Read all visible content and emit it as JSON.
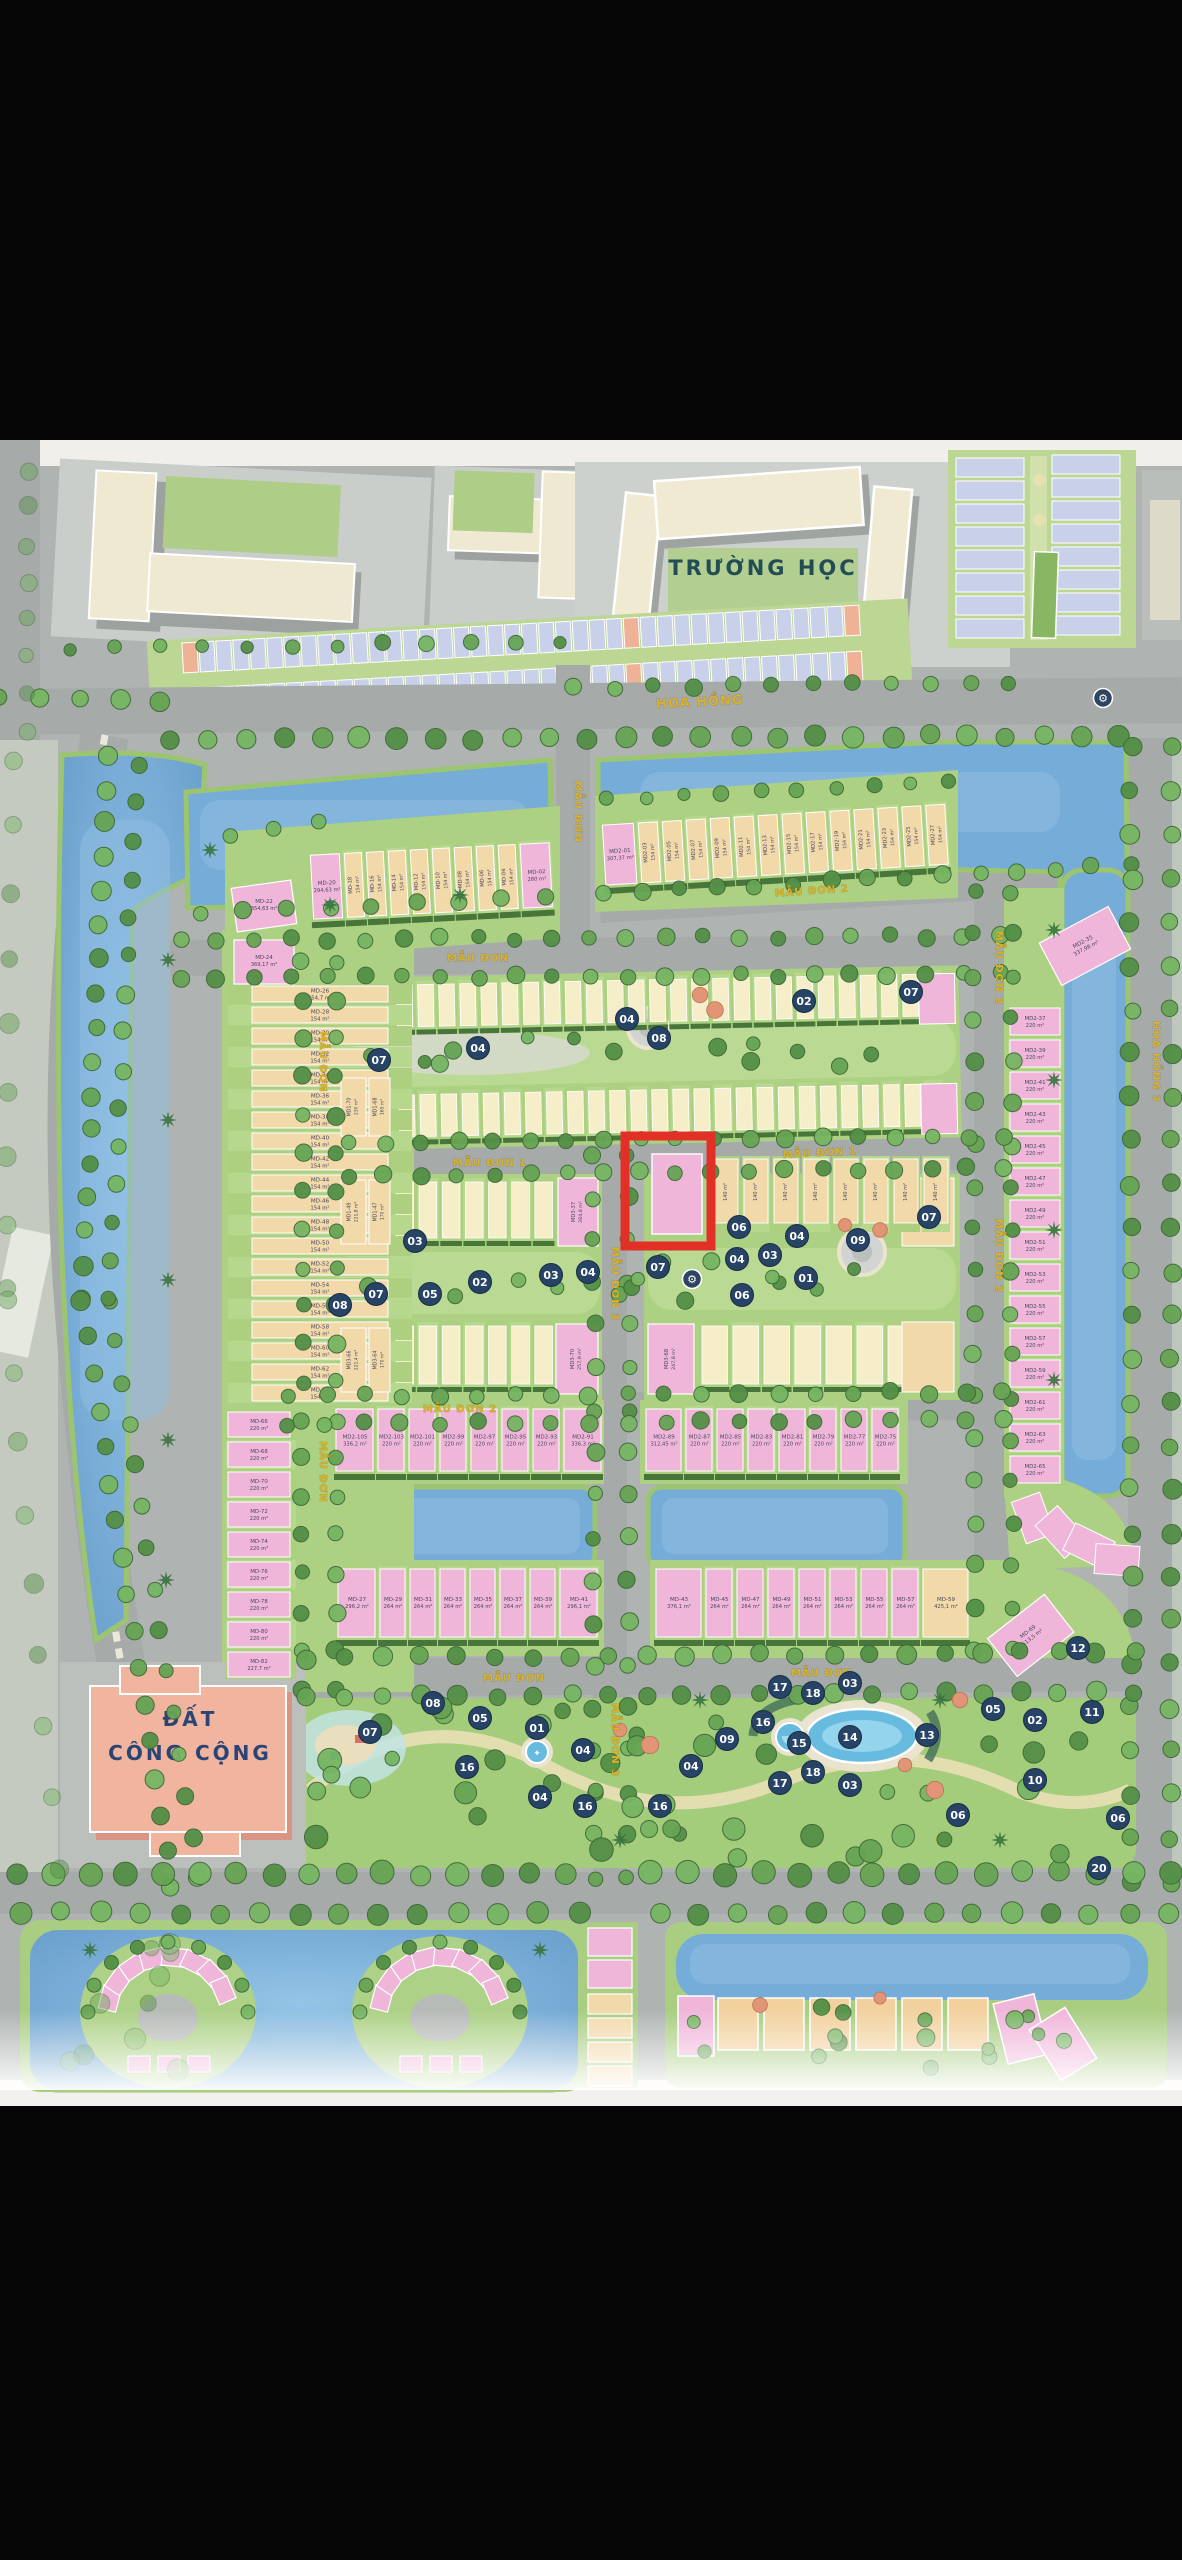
{
  "labels": {
    "school": "TRƯỜNG HỌC",
    "public_land_1": "ĐẤT",
    "public_land_2": "CÔNG CỘNG"
  },
  "colors": {
    "water": "#6fa8d6",
    "road": "#a6abaa",
    "green": "#a9cf7d",
    "tree_green": "#4a8a3d",
    "cream_house": "#f2d7a6",
    "pink_house": "#f0b3d8",
    "pale_row_house": "#f6eec6",
    "blue_roof": "#c7cfe9",
    "highlight_red": "#e1251b",
    "marker_navy": "#1c3a5e",
    "street_yellow": "#d9af1e",
    "school_text": "#17444b",
    "public_text": "#1e3a6e"
  },
  "streets": [
    {
      "label": "HOA HỒNG",
      "x": 700,
      "y": 706,
      "rot": -3,
      "s": 13
    },
    {
      "label": "MẪU ĐƠN",
      "x": 575,
      "y": 812,
      "rot": 90,
      "s": 10
    },
    {
      "label": "MẪU ĐƠN",
      "x": 478,
      "y": 961,
      "rot": 0,
      "s": 10
    },
    {
      "label": "MẪU ĐƠN 2",
      "x": 812,
      "y": 894,
      "rot": -4,
      "s": 10
    },
    {
      "label": "MẪU ĐƠN",
      "x": 320,
      "y": 1062,
      "rot": 90,
      "s": 10
    },
    {
      "label": "MẪU ĐƠN",
      "x": 320,
      "y": 1472,
      "rot": 90,
      "s": 10
    },
    {
      "label": "MẪU ĐƠN 1",
      "x": 490,
      "y": 1166,
      "rot": 0,
      "s": 10
    },
    {
      "label": "MẪU ĐƠN 1",
      "x": 820,
      "y": 1156,
      "rot": -3,
      "s": 10
    },
    {
      "label": "MẪU ĐƠN 2",
      "x": 996,
      "y": 968,
      "rot": 90,
      "s": 10
    },
    {
      "label": "MẪU ĐƠN 2",
      "x": 996,
      "y": 1256,
      "rot": 90,
      "s": 10
    },
    {
      "label": "MẪU ĐƠN 2",
      "x": 460,
      "y": 1412,
      "rot": 0,
      "s": 10
    },
    {
      "label": "MẪU ĐƠN 3",
      "x": 612,
      "y": 1284,
      "rot": 90,
      "s": 10
    },
    {
      "label": "MẪU ĐƠN 3",
      "x": 612,
      "y": 1740,
      "rot": 90,
      "s": 10
    },
    {
      "label": "MẪU ĐƠN",
      "x": 514,
      "y": 1681,
      "rot": 0,
      "s": 10
    },
    {
      "label": "MẪU ĐƠN",
      "x": 822,
      "y": 1676,
      "rot": 0,
      "s": 10
    },
    {
      "label": "HOA HỒNG 3",
      "x": 1153,
      "y": 1062,
      "rot": 90,
      "s": 10
    }
  ],
  "highlight_lot": {
    "name": "MD2-29",
    "area": "208,1 m²"
  },
  "lots": {
    "top_row": [
      {
        "n": "MD-20",
        "a": "294,63 m²",
        "c": "p"
      },
      {
        "n": "MD-18",
        "a": "154 m²",
        "c": "c"
      },
      {
        "n": "MD-16",
        "a": "154 m²",
        "c": "c"
      },
      {
        "n": "MD-14",
        "a": "154 m²",
        "c": "c"
      },
      {
        "n": "MD-12",
        "a": "154 m²",
        "c": "c"
      },
      {
        "n": "MD-10",
        "a": "154 m²",
        "c": "c"
      },
      {
        "n": "MD-08",
        "a": "154 m²",
        "c": "c"
      },
      {
        "n": "MD-06",
        "a": "154 m²",
        "c": "c"
      },
      {
        "n": "MD-04",
        "a": "154 m²",
        "c": "c"
      },
      {
        "n": "MD-02",
        "a": "280 m²",
        "c": "p"
      }
    ],
    "corner_west": [
      {
        "n": "MD-22",
        "a": "354,63 m²",
        "c": "p"
      },
      {
        "n": "MD-24",
        "a": "369,17 m²",
        "c": "p"
      }
    ],
    "west_column_cream": [
      {
        "n": "MD-26",
        "a": "154,7 m²",
        "c": "c"
      },
      {
        "n": "MD-28",
        "a": "154 m²",
        "c": "c"
      },
      {
        "n": "MD-30",
        "a": "154 m²",
        "c": "c"
      },
      {
        "n": "MD-32",
        "a": "154 m²",
        "c": "c"
      },
      {
        "n": "MD-34",
        "a": "154 m²",
        "c": "c"
      },
      {
        "n": "MD-36",
        "a": "154 m²",
        "c": "c"
      },
      {
        "n": "MD-38",
        "a": "154 m²",
        "c": "c"
      },
      {
        "n": "MD-40",
        "a": "154 m²",
        "c": "c"
      },
      {
        "n": "MD-42",
        "a": "154 m²",
        "c": "c"
      },
      {
        "n": "MD-44",
        "a": "154 m²",
        "c": "c"
      },
      {
        "n": "MD-46",
        "a": "154 m²",
        "c": "c"
      },
      {
        "n": "MD-48",
        "a": "154 m²",
        "c": "c"
      },
      {
        "n": "MD-50",
        "a": "154 m²",
        "c": "c"
      },
      {
        "n": "MD-52",
        "a": "154 m²",
        "c": "c"
      },
      {
        "n": "MD-54",
        "a": "154 m²",
        "c": "c"
      },
      {
        "n": "MD-56",
        "a": "154 m²",
        "c": "c"
      },
      {
        "n": "MD-58",
        "a": "154 m²",
        "c": "c"
      },
      {
        "n": "MD-60",
        "a": "154 m²",
        "c": "c"
      },
      {
        "n": "MD-62",
        "a": "154 m²",
        "c": "c"
      },
      {
        "n": "MD-64",
        "a": "154 m²",
        "c": "c"
      }
    ],
    "west_column_pink": [
      {
        "n": "MD-66",
        "a": "220 m²",
        "c": "p"
      },
      {
        "n": "MD-68",
        "a": "220 m²",
        "c": "p"
      },
      {
        "n": "MD-70",
        "a": "220 m²",
        "c": "p"
      },
      {
        "n": "MD-72",
        "a": "220 m²",
        "c": "p"
      },
      {
        "n": "MD-74",
        "a": "220 m²",
        "c": "p"
      },
      {
        "n": "MD-76",
        "a": "220 m²",
        "c": "p"
      },
      {
        "n": "MD-78",
        "a": "220 m²",
        "c": "p"
      },
      {
        "n": "MD-80",
        "a": "220 m²",
        "c": "p"
      },
      {
        "n": "MD-82",
        "a": "227,7 m²",
        "c": "p"
      }
    ],
    "md2_row": [
      {
        "n": "MD2-01",
        "a": "307,37 m²",
        "c": "p"
      },
      {
        "n": "MD2-03",
        "a": "154 m²",
        "c": "c"
      },
      {
        "n": "MD2-05",
        "a": "154 m²",
        "c": "c"
      },
      {
        "n": "MD2-07",
        "a": "154 m²",
        "c": "c"
      },
      {
        "n": "MD2-09",
        "a": "154 m²",
        "c": "c"
      },
      {
        "n": "MD2-11",
        "a": "154 m²",
        "c": "c"
      },
      {
        "n": "MD2-13",
        "a": "154 m²",
        "c": "c"
      },
      {
        "n": "MD2-15",
        "a": "154 m²",
        "c": "c"
      },
      {
        "n": "MD2-17",
        "a": "154 m²",
        "c": "c"
      },
      {
        "n": "MD2-19",
        "a": "154 m²",
        "c": "c"
      },
      {
        "n": "MD2-21",
        "a": "154 m²",
        "c": "c"
      },
      {
        "n": "MD2-23",
        "a": "154 m²",
        "c": "c"
      },
      {
        "n": "MD2-25",
        "a": "154 m²",
        "c": "c"
      },
      {
        "n": "MD2-27",
        "a": "154 m²",
        "c": "c"
      }
    ],
    "east_corner": {
      "n": "MD2-35",
      "a": "337,98 m²",
      "c": "p"
    },
    "east_column": [
      {
        "n": "MD2-37",
        "a": "220 m²",
        "c": "p"
      },
      {
        "n": "MD2-39",
        "a": "220 m²",
        "c": "p"
      },
      {
        "n": "MD2-41",
        "a": "220 m²",
        "c": "p"
      },
      {
        "n": "MD2-43",
        "a": "220 m²",
        "c": "p"
      },
      {
        "n": "MD2-45",
        "a": "220 m²",
        "c": "p"
      },
      {
        "n": "MD2-47",
        "a": "220 m²",
        "c": "p"
      },
      {
        "n": "MD2-49",
        "a": "220 m²",
        "c": "p"
      },
      {
        "n": "MD2-51",
        "a": "220 m²",
        "c": "p"
      },
      {
        "n": "MD2-53",
        "a": "220 m²",
        "c": "p"
      },
      {
        "n": "MD2-55",
        "a": "220 m²",
        "c": "p"
      },
      {
        "n": "MD2-57",
        "a": "220 m²",
        "c": "p"
      },
      {
        "n": "MD2-59",
        "a": "220 m²",
        "c": "p"
      },
      {
        "n": "MD2-61",
        "a": "220 m²",
        "c": "p"
      },
      {
        "n": "MD2-63",
        "a": "220 m²",
        "c": "p"
      },
      {
        "n": "MD2-65",
        "a": "220 m²",
        "c": "p"
      }
    ],
    "lower_left": [
      {
        "n": "MD2-105",
        "a": "336,2 m²",
        "c": "p"
      },
      {
        "n": "MD2-103",
        "a": "220 m²",
        "c": "p"
      },
      {
        "n": "MD2-101",
        "a": "220 m²",
        "c": "p"
      },
      {
        "n": "MD2-99",
        "a": "220 m²",
        "c": "p"
      },
      {
        "n": "MD2-97",
        "a": "220 m²",
        "c": "p"
      },
      {
        "n": "MD2-95",
        "a": "220 m²",
        "c": "p"
      },
      {
        "n": "MD2-93",
        "a": "220 m²",
        "c": "p"
      },
      {
        "n": "MD2-91",
        "a": "336,3 m²",
        "c": "p"
      }
    ],
    "lower_right": [
      {
        "n": "MD2-89",
        "a": "312,45 m²",
        "c": "p"
      },
      {
        "n": "MD2-87",
        "a": "220 m²",
        "c": "p"
      },
      {
        "n": "MD2-85",
        "a": "220 m²",
        "c": "p"
      },
      {
        "n": "MD2-83",
        "a": "220 m²",
        "c": "p"
      },
      {
        "n": "MD2-81",
        "a": "220 m²",
        "c": "p"
      },
      {
        "n": "MD2-79",
        "a": "220 m²",
        "c": "p"
      },
      {
        "n": "MD2-77",
        "a": "220 m²",
        "c": "p"
      },
      {
        "n": "MD2-75",
        "a": "220 m²",
        "c": "p"
      }
    ],
    "bottom_left": [
      {
        "n": "MD-27",
        "a": "296,2 m²",
        "c": "p"
      },
      {
        "n": "MD-29",
        "a": "264 m²",
        "c": "p"
      },
      {
        "n": "MD-31",
        "a": "264 m²",
        "c": "p"
      },
      {
        "n": "MD-33",
        "a": "264 m²",
        "c": "p"
      },
      {
        "n": "MD-35",
        "a": "264 m²",
        "c": "p"
      },
      {
        "n": "MD-37",
        "a": "264 m²",
        "c": "p"
      },
      {
        "n": "MD-39",
        "a": "264 m²",
        "c": "p"
      },
      {
        "n": "MD-41",
        "a": "296,1 m²",
        "c": "p"
      }
    ],
    "bottom_right": [
      {
        "n": "MD-43",
        "a": "376,1 m²",
        "c": "p"
      },
      {
        "n": "MD-45",
        "a": "264 m²",
        "c": "p"
      },
      {
        "n": "MD-47",
        "a": "264 m²",
        "c": "p"
      },
      {
        "n": "MD-49",
        "a": "264 m²",
        "c": "p"
      },
      {
        "n": "MD-51",
        "a": "264 m²",
        "c": "p"
      },
      {
        "n": "MD-53",
        "a": "264 m²",
        "c": "p"
      },
      {
        "n": "MD-55",
        "a": "264 m²",
        "c": "p"
      },
      {
        "n": "MD-57",
        "a": "264 m²",
        "c": "p"
      },
      {
        "n": "MD-59",
        "a": "425,1 m²",
        "c": "c"
      }
    ],
    "bottom_corner": {
      "n": "MD-69",
      "a": "513,5 m²",
      "c": "p"
    },
    "block_corner_lots": [
      {
        "n": "MD1-70",
        "a": "230 m²",
        "c": "c",
        "x": 341,
        "y": 1078,
        "w": 25,
        "h": 58
      },
      {
        "n": "MD1-68",
        "a": "165 m²",
        "c": "c",
        "x": 369,
        "y": 1078,
        "w": 21,
        "h": 58
      },
      {
        "n": "MD1-49",
        "a": "221,8 m²",
        "c": "c",
        "x": 341,
        "y": 1180,
        "w": 25,
        "h": 64
      },
      {
        "n": "MD1-47",
        "a": "170 m²",
        "c": "c",
        "x": 369,
        "y": 1180,
        "w": 21,
        "h": 64
      },
      {
        "n": "MD3-66",
        "a": "221,4 m²",
        "c": "c",
        "x": 341,
        "y": 1328,
        "w": 25,
        "h": 64
      },
      {
        "n": "MD3-64",
        "a": "170 m²",
        "c": "c",
        "x": 369,
        "y": 1328,
        "w": 21,
        "h": 64
      }
    ],
    "block_end_lots": [
      {
        "n": "MD3-37",
        "a": "284,8 m²",
        "c": "p",
        "x": 558,
        "y": 1178,
        "w": 40,
        "h": 68
      },
      {
        "n": "MD3-70",
        "a": "257,9 m²",
        "c": "p",
        "x": 556,
        "y": 1324,
        "w": 42,
        "h": 70
      },
      {
        "n": "MD3-68",
        "a": "247,8 m²",
        "c": "p",
        "x": 648,
        "y": 1324,
        "w": 46,
        "h": 70
      }
    ],
    "small_row": {
      "count": 8,
      "area": "140 m²"
    }
  },
  "markers": [
    {
      "n": "04",
      "x": 478,
      "y": 1048
    },
    {
      "n": "07",
      "x": 379,
      "y": 1060
    },
    {
      "n": "04",
      "x": 627,
      "y": 1019
    },
    {
      "n": "08",
      "x": 659,
      "y": 1038
    },
    {
      "n": "02",
      "x": 804,
      "y": 1001
    },
    {
      "n": "07",
      "x": 911,
      "y": 992
    },
    {
      "n": "03",
      "x": 415,
      "y": 1241
    },
    {
      "n": "05",
      "x": 430,
      "y": 1294
    },
    {
      "n": "07",
      "x": 376,
      "y": 1294
    },
    {
      "n": "08",
      "x": 340,
      "y": 1305
    },
    {
      "n": "02",
      "x": 480,
      "y": 1282
    },
    {
      "n": "03",
      "x": 551,
      "y": 1275
    },
    {
      "n": "04",
      "x": 588,
      "y": 1272
    },
    {
      "n": "07",
      "x": 658,
      "y": 1267
    },
    {
      "n": "06",
      "x": 739,
      "y": 1227
    },
    {
      "n": "04",
      "x": 797,
      "y": 1236
    },
    {
      "n": "03",
      "x": 770,
      "y": 1255
    },
    {
      "n": "04",
      "x": 737,
      "y": 1259
    },
    {
      "n": "01",
      "x": 806,
      "y": 1278
    },
    {
      "n": "06",
      "x": 742,
      "y": 1295
    },
    {
      "n": "09",
      "x": 858,
      "y": 1240
    },
    {
      "n": "07",
      "x": 929,
      "y": 1217
    },
    {
      "n": "12",
      "x": 1078,
      "y": 1648
    },
    {
      "n": "07",
      "x": 370,
      "y": 1732
    },
    {
      "n": "08",
      "x": 433,
      "y": 1703
    },
    {
      "n": "05",
      "x": 480,
      "y": 1718
    },
    {
      "n": "01",
      "x": 537,
      "y": 1728
    },
    {
      "n": "04",
      "x": 583,
      "y": 1750
    },
    {
      "n": "16",
      "x": 467,
      "y": 1767
    },
    {
      "n": "04",
      "x": 540,
      "y": 1797
    },
    {
      "n": "16",
      "x": 585,
      "y": 1806
    },
    {
      "n": "17",
      "x": 780,
      "y": 1687
    },
    {
      "n": "18",
      "x": 813,
      "y": 1693
    },
    {
      "n": "03",
      "x": 850,
      "y": 1683
    },
    {
      "n": "16",
      "x": 763,
      "y": 1722
    },
    {
      "n": "09",
      "x": 727,
      "y": 1739
    },
    {
      "n": "15",
      "x": 799,
      "y": 1743
    },
    {
      "n": "14",
      "x": 850,
      "y": 1737
    },
    {
      "n": "13",
      "x": 927,
      "y": 1735
    },
    {
      "n": "04",
      "x": 691,
      "y": 1766
    },
    {
      "n": "18",
      "x": 813,
      "y": 1772
    },
    {
      "n": "17",
      "x": 780,
      "y": 1783
    },
    {
      "n": "03",
      "x": 850,
      "y": 1785
    },
    {
      "n": "16",
      "x": 660,
      "y": 1806
    },
    {
      "n": "06",
      "x": 958,
      "y": 1815
    },
    {
      "n": "05",
      "x": 993,
      "y": 1709
    },
    {
      "n": "02",
      "x": 1035,
      "y": 1720
    },
    {
      "n": "10",
      "x": 1035,
      "y": 1780
    },
    {
      "n": "11",
      "x": 1092,
      "y": 1712
    },
    {
      "n": "06",
      "x": 1118,
      "y": 1818
    },
    {
      "n": "20",
      "x": 1099,
      "y": 1868
    }
  ],
  "gear_icons": [
    {
      "x": 1103,
      "y": 698
    },
    {
      "x": 692,
      "y": 1279
    }
  ]
}
